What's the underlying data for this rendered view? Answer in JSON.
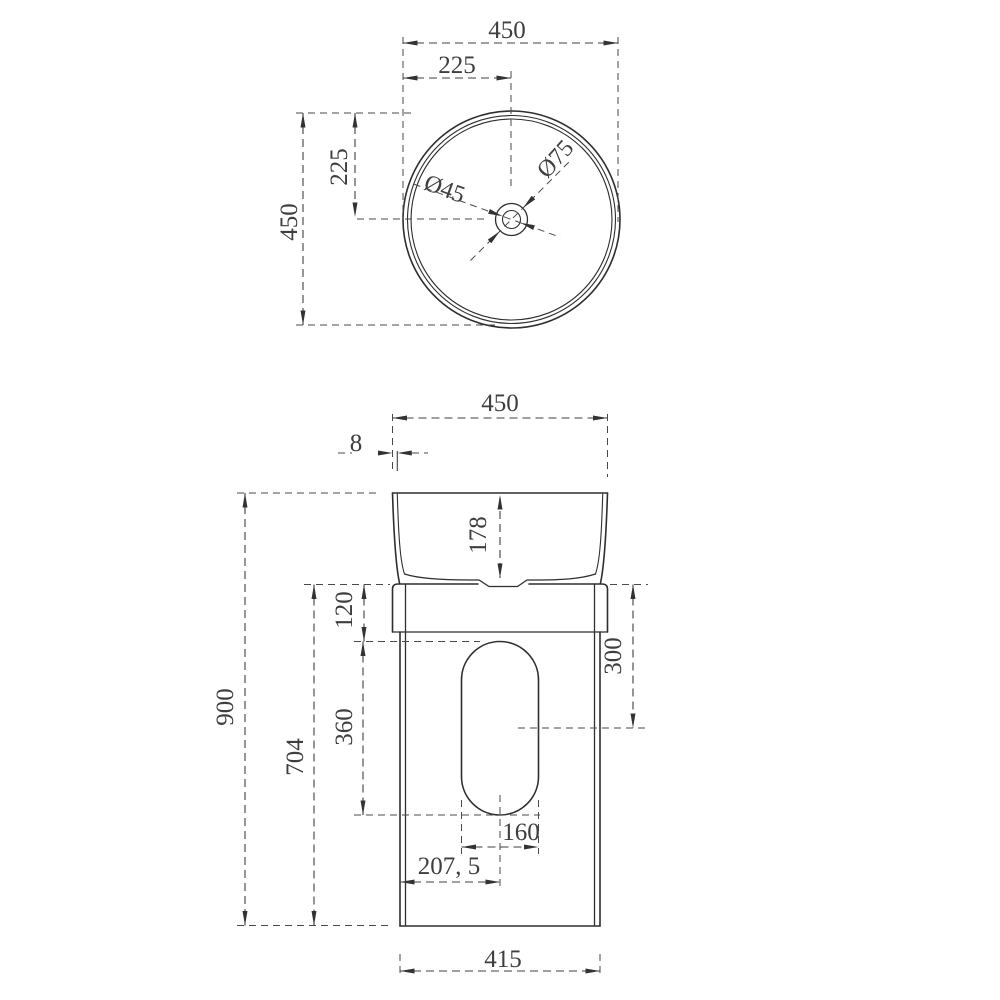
{
  "drawing": {
    "kind": "pedestal basin technical drawing",
    "colors": {
      "line": "#2e2e2e",
      "dimension": "#3f3f3f",
      "background": "#ffffff"
    },
    "top_view": {
      "width_label": "450",
      "half_width_label": "225",
      "height_label": "450",
      "half_height_label": "225",
      "drain_inner_dia_label": "Ø45",
      "drain_outer_dia_label": "Ø75"
    },
    "front_view": {
      "top_width_label": "450",
      "rim_thickness_label": "8",
      "basin_depth_label": "178",
      "overall_height_label": "900",
      "pedestal_height_label": "704",
      "cutout_top_offset_label": "120",
      "cutout_height_label": "360",
      "cutout_center_offset_label": "300",
      "cutout_width_label": "160",
      "cutout_center_x_label": "207, 5",
      "base_width_label": "415"
    }
  }
}
